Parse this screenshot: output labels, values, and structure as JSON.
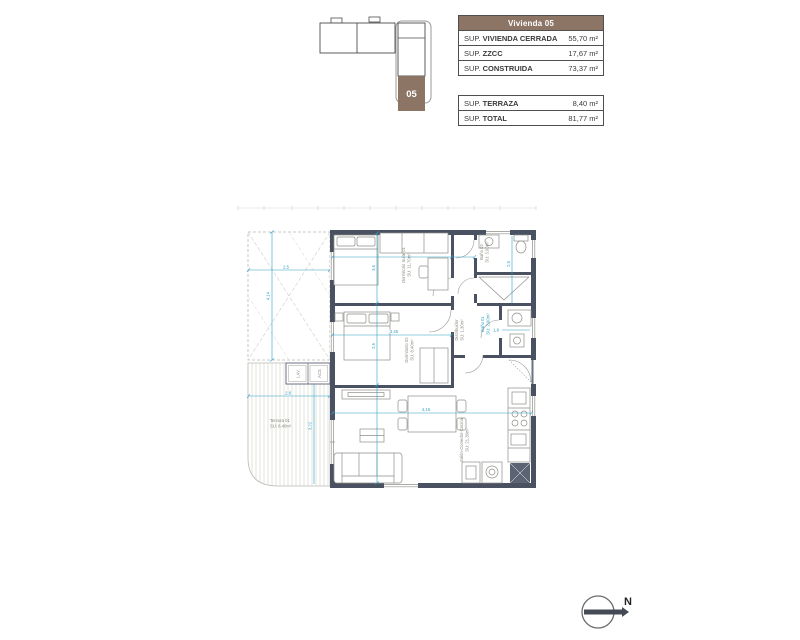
{
  "key_plan": {
    "unit_label": "05",
    "unit_color": "#8d7566"
  },
  "area_tables": {
    "header": "Vivienda 05",
    "header_bg": "#8d7566",
    "table1": [
      {
        "prefix": "SUP.",
        "label": "VIVIENDA CERRADA",
        "value": "55,70 m²"
      },
      {
        "prefix": "SUP.",
        "label": "ZZCC",
        "value": "17,67 m²"
      },
      {
        "prefix": "SUP.",
        "label": "CONSTRUIDA",
        "value": "73,37 m²"
      }
    ],
    "table2": [
      {
        "prefix": "SUP.",
        "label": "TERRAZA",
        "value": "8,40 m²"
      },
      {
        "prefix": "SUP.",
        "label": "TOTAL",
        "value": "81,77 m²"
      }
    ]
  },
  "floor_plan": {
    "rooms": {
      "suite": {
        "name": "Dormitorio Suite 01",
        "area": "SU: 11,70m²"
      },
      "bano02": {
        "name": "Baño 02",
        "area": "SU: 3,00m²"
      },
      "bano01": {
        "name": "Baño 01",
        "area": "SU: 2,00m²"
      },
      "distribuidor": {
        "name": "Distribuidor",
        "area": "SU: 1,30m²"
      },
      "dorm02": {
        "name": "Dormitorio 02",
        "area": "SU: 8,40m²"
      },
      "salon": {
        "name": "Salón-Comedor-Cocina",
        "area": "SU: 21,39m²"
      },
      "terraza": {
        "name": "Terraza 01",
        "area": "SU: 8,40m²"
      }
    },
    "closets": {
      "lav": "LAV.",
      "acs": "ACS"
    },
    "dimensions": {
      "outdoor_w": "2,5",
      "outdoor_h": "4,14",
      "terraza_w": "2,8",
      "terraza_h": "3,22",
      "suite_h": "3,6",
      "dorm02_w": "3,46",
      "dorm02_h": "2,6",
      "salon_w": "4,16",
      "bano02_h": "2,5",
      "bano01_w": "1,8"
    },
    "colors": {
      "wall": "#4a5160",
      "dimension": "#2e9fc5",
      "accent_brown": "#8d7566"
    }
  },
  "compass": {
    "label": "N"
  }
}
